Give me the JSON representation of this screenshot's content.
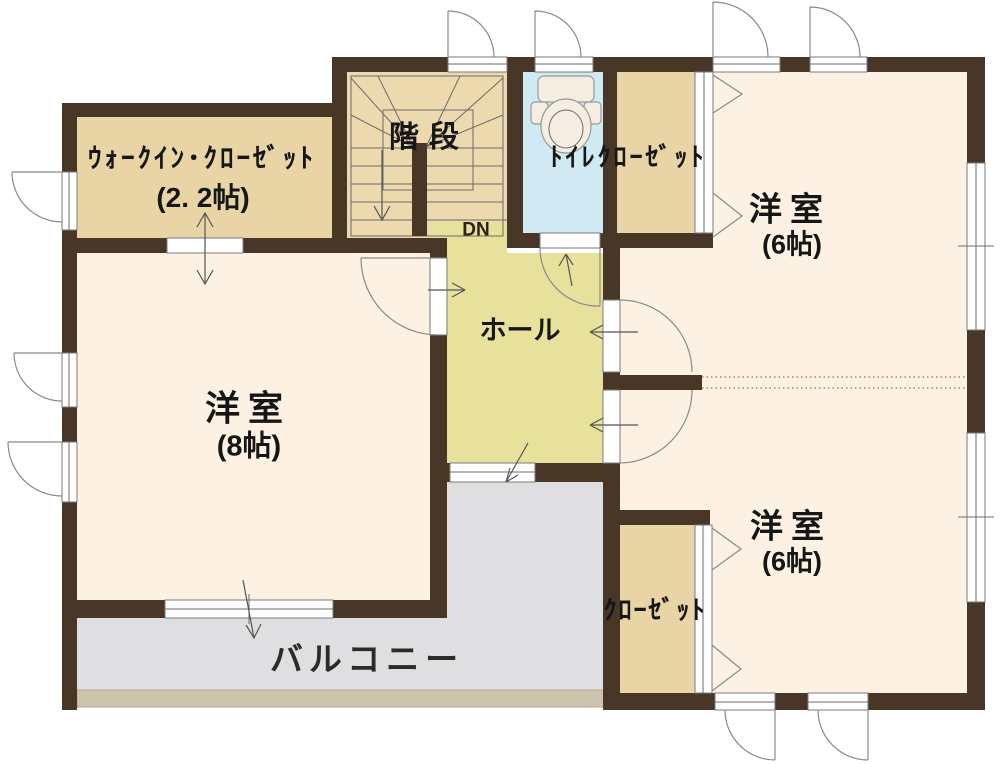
{
  "labels": {
    "walk_in_closet": {
      "name": "ｳｫｰｸｲﾝ･ｸﾛｰｾﾞｯﾄ",
      "size": "(2. 2帖)"
    },
    "stairs": "階段",
    "down": "DN",
    "toilet_closet": "ﾄｲﾚｸﾛｰｾﾞｯﾄ",
    "room_top_right": {
      "name": "洋室",
      "size": "(6帖)"
    },
    "room_left": {
      "name": "洋室",
      "size": "(8帖)"
    },
    "hall": "ホール",
    "room_bottom_right": {
      "name": "洋室",
      "size": "(6帖)"
    },
    "closet": "ｸﾛｰｾﾞｯﾄ",
    "balcony": "バルコニー"
  },
  "colors": {
    "wall": "#483726",
    "room": "#fcf1e2",
    "closet": "#e9d4a5",
    "stairs": "#edd9ae",
    "hall": "#e8e19c",
    "toilet": "#cfeaf3",
    "balcony": "#dfdfe1",
    "balcony_edge": "#cdc2ad"
  }
}
